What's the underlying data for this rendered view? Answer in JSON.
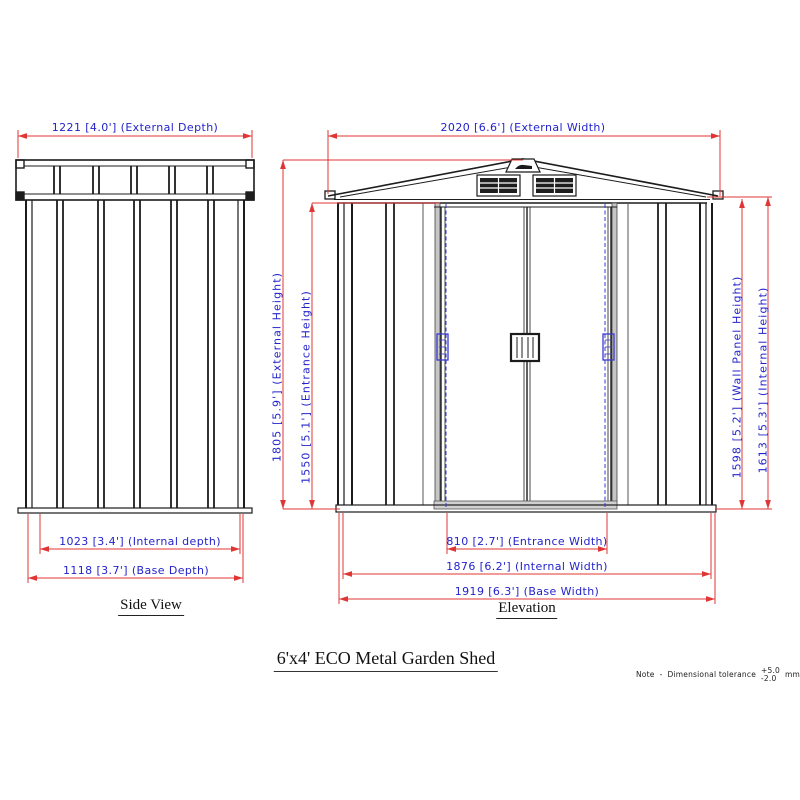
{
  "title": "6'x4' ECO Metal Garden Shed",
  "side": {
    "label": "Side View",
    "dims": {
      "external_depth": "1221 [4.0'] (External Depth)",
      "internal_depth": "1023 [3.4'] (Internal depth)",
      "base_depth": "1118 [3.7'] (Base Depth)"
    }
  },
  "elev": {
    "label": "Elevation",
    "dims": {
      "external_width": "2020 [6.6'] (External Width)",
      "external_height": "1805 [5.9'] (External Height)",
      "entrance_height": "1550 [5.1'] (Entrance Height)",
      "wall_panel_height": "1598 [5.2'] (Wall Panel Height)",
      "internal_height": "1613 [5.3'] (Internal Height)",
      "entrance_width": "810 [2.7'] (Entrance Width)",
      "internal_width": "1876 [6.2'] (Internal Width)",
      "base_width": "1919 [6.3'] (Base Width)"
    }
  },
  "note": {
    "label": "Note",
    "dash": "-",
    "body": "Dimensional tolerance",
    "plus": "+5.0",
    "minus": "-2.0",
    "unit": "mm."
  },
  "colors": {
    "dimension_line": "#e03535",
    "dimension_text": "#2323cc",
    "drawing_line": "#1c1c1c",
    "accent_blue": "#3a3ad0"
  }
}
